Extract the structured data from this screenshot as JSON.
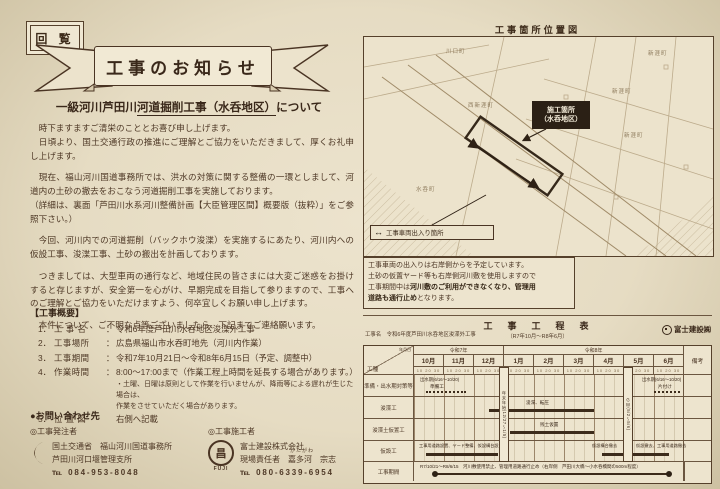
{
  "page": {
    "kairan": "回 覧",
    "banner": "工事のお知らせ",
    "title_pre": "一級河川芦田川",
    "title_main": "河道掘削工事（水呑地区）",
    "title_post": "について"
  },
  "notice": {
    "p1a": "　時下ますますご清栄のこととお喜び申し上げます。",
    "p1b": "　日頃より、国土交通行政の推進にご理解とご協力をいただきまして、厚くお礼申し上げます。",
    "p2a": "　現在、福山河川国道事務所では、洪水の対策に関する整備の一環としまして、河道内の土砂の撤去をおこなう河道掘削工事を実施しております。",
    "p2b": "（詳細は、裏面「芦田川水系河川整備計画【大臣管理区間】概要版（抜粋）」をご参照下さい。）",
    "p3": "　今回、河川内での河道掘削（バックホウ浚渫）を実施するにあたり、河川内への仮設工事、浚渫工事、土砂の搬出を計画しております。",
    "p4": "　つきましては、大型車両の通行など、地域住民の皆さまには大変ご迷惑をお掛けすると存じますが、安全第一を心がけ、早期完成を目指して参りますので、工事へのご理解とご協力をいただけますよう、何卒宜しくお願い申し上げます。",
    "p5": "　本件について、ご不明な点等ございましたら、下記までご連絡願います。"
  },
  "overview": {
    "heading": "【工事概要】",
    "items": [
      {
        "no": "1．",
        "label": "工 事 名",
        "sep": "：",
        "value": "令和6年度芦田川水呑地区浚渫外工事"
      },
      {
        "no": "2．",
        "label": "工事場所",
        "sep": "：",
        "value": "広島県福山市水呑町地先（河川内作業）"
      },
      {
        "no": "3．",
        "label": "工事期間",
        "sep": "：",
        "value": "令和7年10月21日～令和8年6月15日（予定、調整中）"
      },
      {
        "no": "4．",
        "label": "作業時間",
        "sep": "：",
        "value": "8:00～17:00まで（作業工程上時間を延長する場合があります。）"
      },
      {
        "no": "5．",
        "label": "位 置 図",
        "sep": "",
        "value": "右側へ記載"
      }
    ],
    "note1": "・土曜、日曜は原則として作業を行いませんが、降雨等による遅れが生じた場合は、",
    "note2": "作業をさせていただく場合があります。"
  },
  "contact": {
    "heading": "●お問い合わせ先",
    "orderer": {
      "heading": "◎工事発注者",
      "line1": "国土交通省　福山河川国道事務所",
      "line2": "芦田川河口堰管理支所",
      "tel": "℡ 084-953-8048"
    },
    "contractor": {
      "heading": "◎工事施工者",
      "line1": "富士建設株式会社",
      "resp_prefix": "現場責任者　",
      "resp_name": "嘉多河",
      "resp_furi": "かたがわ",
      "resp_given": "　宗志",
      "tel": "℡ 080-6339-6954",
      "logo_glyph": "昌",
      "logo_text": "FUJI"
    }
  },
  "map": {
    "title": "工事箇所位置図",
    "site_line1": "施工箇所",
    "site_line2": "（水呑地区）",
    "legend_arrow": "↔",
    "legend": "工事車両出入り箇所",
    "note_l1": "工事車両の出入りは右岸側からを予定しています。",
    "note_l2": "土砂の仮置ヤード等も右岸側河川敷を使用しますので",
    "note_l3a": "工事期間中は",
    "note_l3b": "河川敷のご利用ができなくなり、管理用",
    "note_l4a": "道路も通行止め",
    "note_l4b": "となります。",
    "places": [
      "川口町",
      "新涯町",
      "新涯町",
      "西新涯町",
      "新涯町",
      "水呑町"
    ]
  },
  "schedule": {
    "title": "工　事　工　程　表",
    "subtitle": "（R7年10月～R8年6月）",
    "project_label": "工事名　令和6年度芦田川水呑地区浚渫外工事",
    "company": "富士建設㈱",
    "era1": "令和7年",
    "era2": "令和8年",
    "months": [
      "10月",
      "11月",
      "12月",
      "1月",
      "2月",
      "3月",
      "4月",
      "5月",
      "6月"
    ],
    "tick": "10 20 30",
    "biko": "備考",
    "koushu": "工種",
    "ymd": "年月日",
    "rows": [
      "準備・出水期対策等",
      "浚渫工",
      "浚渫土仮置工",
      "仮設工",
      "工事期間"
    ],
    "flood1": "出水期(6/16～10/20)",
    "prep": "準備工",
    "flood2": "出水期(6/16～10/20)",
    "cleanup": "片付け",
    "dredge": "浚渫、転圧",
    "stockpile": "残土仮置",
    "setup": "工事用道路設置、ヤード整備、仮設構台設置",
    "removeA": "仮設構台撤去",
    "removeB": "仮設撤去、工事用道路撤去",
    "period": "R7/10/21～R8/6/15　河川敷使用禁止、管理用道路通行止め（右岸側　芦田川大橋～小水呑橋間の500m程度）",
    "yearend": "年末年始(12/27～1/5)",
    "gw": "ＧＷ(5/2～5/6)"
  }
}
